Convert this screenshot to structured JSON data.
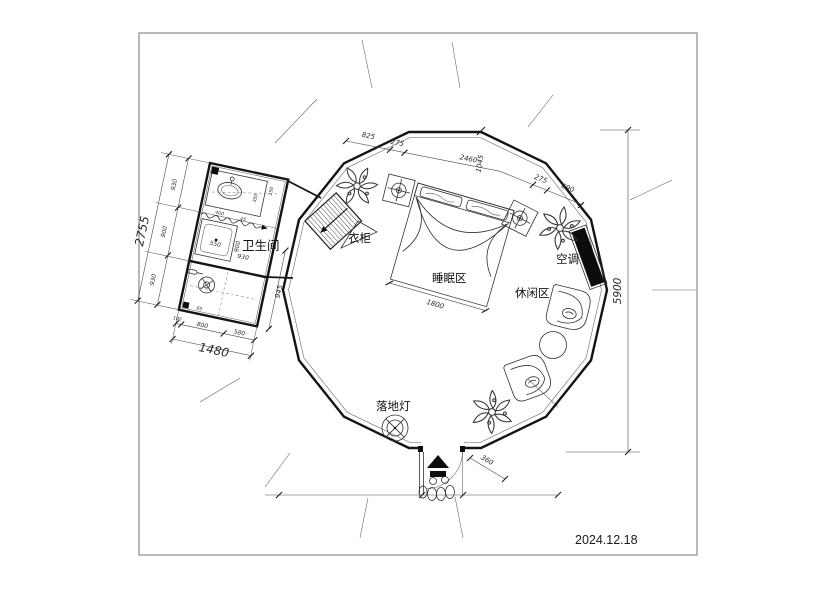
{
  "meta": {
    "date": "2024.12.18"
  },
  "labels": {
    "bathroom": "卫生间",
    "wardrobe": "衣柜",
    "sleeping": "睡眠区",
    "leisure": "休闲区",
    "ac": "空调",
    "floor_lamp": "落地灯"
  },
  "dims": {
    "top": [
      "825",
      "275",
      "2460",
      "1045",
      "275",
      "690"
    ],
    "overall_height": "5900",
    "bed_width": "1800",
    "entry": "360",
    "bath_overall_left": "2755",
    "bath_left": [
      "930",
      "900",
      "930"
    ],
    "bath_overall_bottom": "1480",
    "bath_bottom": [
      "100",
      "800",
      "580"
    ],
    "bath_right": "945",
    "shower": "550",
    "bath_inner_930": "930",
    "bath_inner_900": "900",
    "vanity_400": "400",
    "vanity_350": "350",
    "vanity_150": "150",
    "vanity_45": "45",
    "corner_95": "95"
  }
}
